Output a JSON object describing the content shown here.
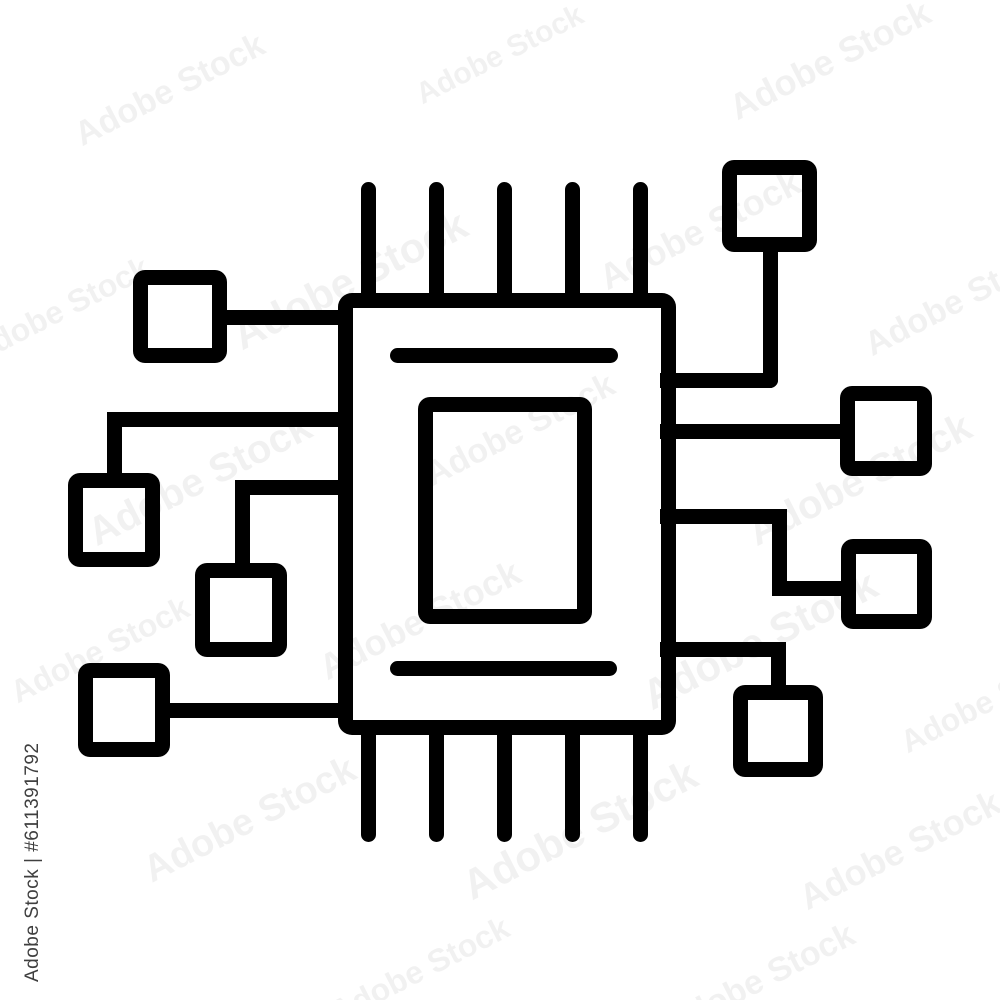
{
  "image": {
    "width": 1000,
    "height": 1000,
    "background": "#ffffff"
  },
  "icon": {
    "name": "microchip-circuit-icon",
    "stroke_color": "#000000",
    "stroke_width": 15,
    "shapes": [
      {
        "name": "chip-body",
        "type": "outline",
        "x": 337.5,
        "y": 293,
        "w": 338,
        "h": 442,
        "radius": "14px"
      },
      {
        "name": "chip-core",
        "type": "outline",
        "x": 418,
        "y": 397,
        "w": 174,
        "h": 227,
        "radius": "12px"
      },
      {
        "name": "core-line-top",
        "type": "fill",
        "x": 390,
        "y": 348,
        "w": 228,
        "h": 15,
        "radius": "8px"
      },
      {
        "name": "core-line-bottom",
        "type": "fill",
        "x": 390,
        "y": 661,
        "w": 227,
        "h": 15,
        "radius": "8px"
      },
      {
        "name": "pin-top-1",
        "type": "fill",
        "x": 360.5,
        "y": 182,
        "w": 15,
        "h": 126,
        "radius": "8px 8px 0 0"
      },
      {
        "name": "pin-top-2",
        "type": "fill",
        "x": 428.5,
        "y": 182,
        "w": 15,
        "h": 126,
        "radius": "8px 8px 0 0"
      },
      {
        "name": "pin-top-3",
        "type": "fill",
        "x": 496.5,
        "y": 182,
        "w": 15,
        "h": 126,
        "radius": "8px 8px 0 0"
      },
      {
        "name": "pin-top-4",
        "type": "fill",
        "x": 564.5,
        "y": 182,
        "w": 15,
        "h": 126,
        "radius": "8px 8px 0 0"
      },
      {
        "name": "pin-top-5",
        "type": "fill",
        "x": 632.5,
        "y": 182,
        "w": 15,
        "h": 126,
        "radius": "8px 8px 0 0"
      },
      {
        "name": "pin-bottom-1",
        "type": "fill",
        "x": 360.5,
        "y": 720,
        "w": 15,
        "h": 122,
        "radius": "0 0 8px 8px"
      },
      {
        "name": "pin-bottom-2",
        "type": "fill",
        "x": 428.5,
        "y": 720,
        "w": 15,
        "h": 122,
        "radius": "0 0 8px 8px"
      },
      {
        "name": "pin-bottom-3",
        "type": "fill",
        "x": 496.5,
        "y": 720,
        "w": 15,
        "h": 122,
        "radius": "0 0 8px 8px"
      },
      {
        "name": "pin-bottom-4",
        "type": "fill",
        "x": 564.5,
        "y": 720,
        "w": 15,
        "h": 122,
        "radius": "0 0 8px 8px"
      },
      {
        "name": "pin-bottom-5",
        "type": "fill",
        "x": 632.5,
        "y": 720,
        "w": 15,
        "h": 122,
        "radius": "0 0 8px 8px"
      },
      {
        "name": "node-top-left",
        "type": "outline",
        "x": 133,
        "y": 270,
        "w": 94,
        "h": 93,
        "radius": "12px"
      },
      {
        "name": "node-mid-left",
        "type": "outline",
        "x": 68,
        "y": 473,
        "w": 92,
        "h": 94,
        "radius": "12px"
      },
      {
        "name": "node-lower-left",
        "type": "outline",
        "x": 195,
        "y": 563,
        "w": 92,
        "h": 94,
        "radius": "12px"
      },
      {
        "name": "node-bottom-left",
        "type": "outline",
        "x": 78,
        "y": 663,
        "w": 92,
        "h": 94,
        "radius": "12px"
      },
      {
        "name": "node-top-right",
        "type": "outline",
        "x": 722,
        "y": 160,
        "w": 95,
        "h": 92,
        "radius": "12px"
      },
      {
        "name": "node-mid-right",
        "type": "outline",
        "x": 840,
        "y": 386,
        "w": 92,
        "h": 90,
        "radius": "12px"
      },
      {
        "name": "node-lower-right",
        "type": "outline",
        "x": 841,
        "y": 539,
        "w": 91,
        "h": 90,
        "radius": "12px"
      },
      {
        "name": "node-bottom-right",
        "type": "outline",
        "x": 733,
        "y": 685,
        "w": 90,
        "h": 92,
        "radius": "12px"
      },
      {
        "name": "conn-left-1",
        "type": "fill",
        "x": 219,
        "y": 309.5,
        "w": 126,
        "h": 15,
        "radius": "0"
      },
      {
        "name": "conn-left-2-h",
        "type": "fill",
        "x": 106.5,
        "y": 411.5,
        "w": 245.5,
        "h": 15,
        "radius": "8px 0 0 0"
      },
      {
        "name": "conn-left-2-v",
        "type": "fill",
        "x": 106.5,
        "y": 411.5,
        "w": 15,
        "h": 61.5,
        "radius": "0"
      },
      {
        "name": "conn-left-3-h",
        "type": "fill",
        "x": 234.5,
        "y": 479.5,
        "w": 117.5,
        "h": 15,
        "radius": "8px 0 0 0"
      },
      {
        "name": "conn-left-3-v",
        "type": "fill",
        "x": 234.5,
        "y": 479.5,
        "w": 15,
        "h": 83.5,
        "radius": "0"
      },
      {
        "name": "conn-left-4",
        "type": "fill",
        "x": 170,
        "y": 702.5,
        "w": 175,
        "h": 15,
        "radius": "0"
      },
      {
        "name": "conn-right-1-v",
        "type": "fill",
        "x": 762.5,
        "y": 252,
        "w": 15,
        "h": 135.5,
        "radius": "0 0 8px 0"
      },
      {
        "name": "conn-right-1-h",
        "type": "fill",
        "x": 660,
        "y": 372.5,
        "w": 117.5,
        "h": 15,
        "radius": "0 0 8px 0"
      },
      {
        "name": "conn-right-2",
        "type": "fill",
        "x": 660,
        "y": 423.5,
        "w": 180,
        "h": 15,
        "radius": "0"
      },
      {
        "name": "conn-right-3-h1",
        "type": "fill",
        "x": 660,
        "y": 508.5,
        "w": 126.5,
        "h": 15,
        "radius": "0 8px 0 0"
      },
      {
        "name": "conn-right-3-v",
        "type": "fill",
        "x": 771.5,
        "y": 508.5,
        "w": 15,
        "h": 87,
        "radius": "0 0 0 8px"
      },
      {
        "name": "conn-right-3-h2",
        "type": "fill",
        "x": 771.5,
        "y": 580.5,
        "w": 69.5,
        "h": 15,
        "radius": "0"
      },
      {
        "name": "conn-right-4-h",
        "type": "fill",
        "x": 660,
        "y": 641.5,
        "w": 125.5,
        "h": 15,
        "radius": "0 8px 0 0"
      },
      {
        "name": "conn-right-4-v",
        "type": "fill",
        "x": 770.5,
        "y": 641.5,
        "w": 15,
        "h": 43.5,
        "radius": "0"
      }
    ]
  },
  "watermarks": {
    "id_label": {
      "text": "Adobe Stock | #611391792",
      "color": "#3f3f3f",
      "font_size": 19,
      "x": 22,
      "y": 982,
      "rotation": -90
    },
    "tile": {
      "text": "Adobe Stock",
      "color": "#000000",
      "opacity": 0.05,
      "rotation": -27,
      "instances": [
        {
          "x": 170,
          "y": 90,
          "size": 34
        },
        {
          "x": 500,
          "y": 55,
          "size": 30
        },
        {
          "x": 830,
          "y": 60,
          "size": 36
        },
        {
          "x": 60,
          "y": 310,
          "size": 32
        },
        {
          "x": 350,
          "y": 280,
          "size": 42
        },
        {
          "x": 700,
          "y": 230,
          "size": 36
        },
        {
          "x": 960,
          "y": 300,
          "size": 34
        },
        {
          "x": 200,
          "y": 480,
          "size": 40
        },
        {
          "x": 520,
          "y": 430,
          "size": 34
        },
        {
          "x": 860,
          "y": 480,
          "size": 40
        },
        {
          "x": 100,
          "y": 650,
          "size": 32
        },
        {
          "x": 420,
          "y": 620,
          "size": 36
        },
        {
          "x": 760,
          "y": 640,
          "size": 42
        },
        {
          "x": 990,
          "y": 700,
          "size": 32
        },
        {
          "x": 250,
          "y": 820,
          "size": 38
        },
        {
          "x": 580,
          "y": 830,
          "size": 42
        },
        {
          "x": 900,
          "y": 850,
          "size": 36
        },
        {
          "x": 420,
          "y": 970,
          "size": 32
        },
        {
          "x": 760,
          "y": 980,
          "size": 34
        }
      ]
    }
  }
}
